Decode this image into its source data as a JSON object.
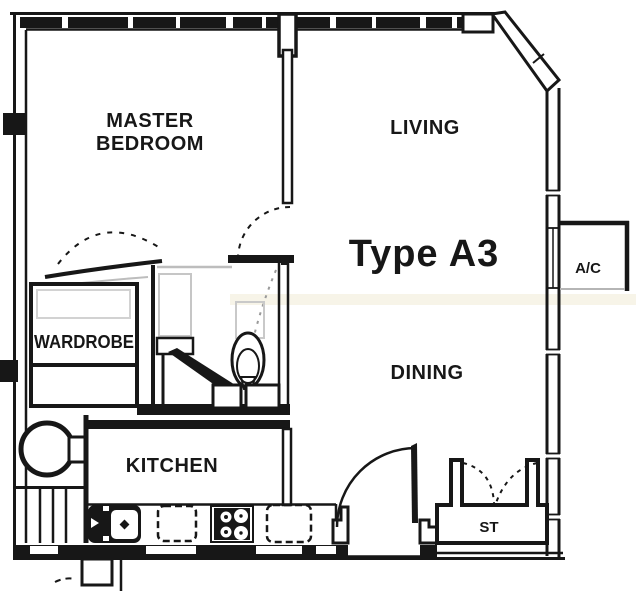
{
  "floor_plan": {
    "unit_type_label": "Type A3",
    "rooms": {
      "master_bedroom_line1": "MASTER",
      "master_bedroom_line2": "BEDROOM",
      "living": "LIVING",
      "dining": "DINING",
      "kitchen": "KITCHEN",
      "wardrobe": "WARDROBE",
      "store": "ST",
      "ac_ledge": "A/C"
    },
    "colors": {
      "ink": "#171717",
      "paper": "#ffffff",
      "faded": "#c2c2c2",
      "smudge": "rgba(195,175,95,0.14)"
    }
  }
}
